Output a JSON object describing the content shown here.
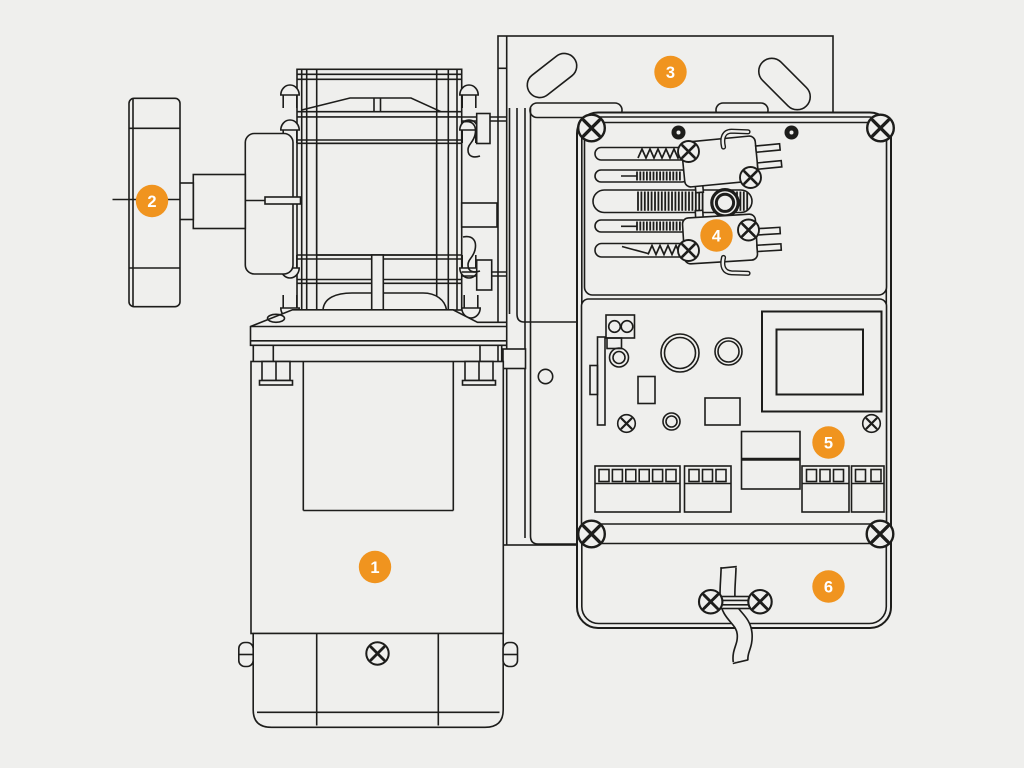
{
  "colors": {
    "background": "#efefed",
    "line": "#1d1d1b",
    "accent": "#f0941f",
    "callout_text": "#ffffff"
  },
  "diagram": {
    "callout_radius": 16.2,
    "callouts": [
      {
        "number": "1",
        "x": 375,
        "y": 567
      },
      {
        "number": "2",
        "x": 152,
        "y": 201
      },
      {
        "number": "3",
        "x": 670.5,
        "y": 72
      },
      {
        "number": "4",
        "x": 716.5,
        "y": 235.5
      },
      {
        "number": "5",
        "x": 828.5,
        "y": 442.5
      },
      {
        "number": "6",
        "x": 828.5,
        "y": 586.5
      }
    ]
  }
}
